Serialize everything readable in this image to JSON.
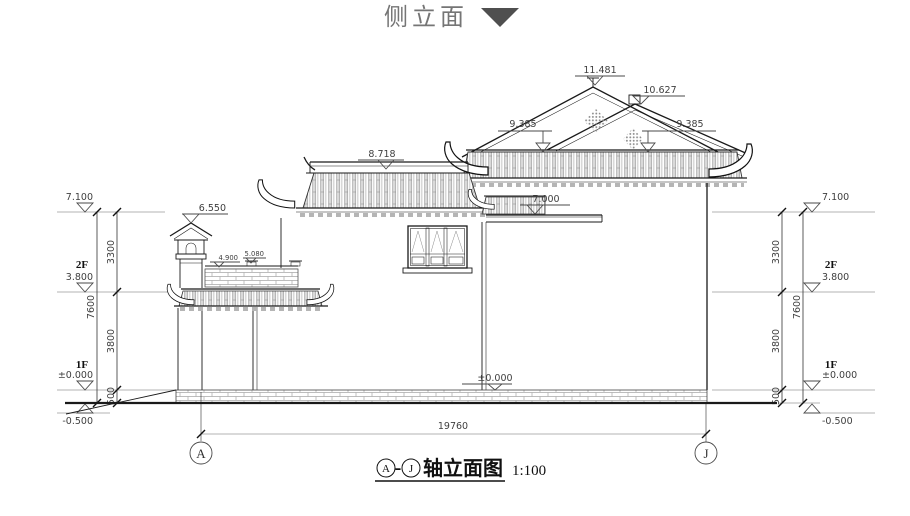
{
  "title": {
    "text": "侧立面"
  },
  "caption": {
    "axis_a": "A",
    "dash": "-",
    "axis_j": "J",
    "label": "轴立面图",
    "scale": "1:100"
  },
  "axes": {
    "a": "A",
    "j": "J"
  },
  "dims": {
    "total_width": "19760"
  },
  "marks": {
    "ridge_main": "11.481",
    "ridge_rear": "10.627",
    "eave_left": "9.385",
    "eave_right": "9.385",
    "left_roof": "8.718",
    "mid_roof": "7.000",
    "tower_top": "6.550",
    "post_cap": "5.080",
    "railing_top": "4.900",
    "ground_center": "±0.000"
  },
  "left_stack": {
    "parapet": "7.100",
    "floor2_label": "2F",
    "floor2": "3.800",
    "floor1_label": "1F",
    "floor1": "±0.000",
    "site": "-0.500",
    "seg_top": "3300",
    "seg_mid": "3800",
    "seg_low": "500",
    "total": "7600"
  },
  "right_stack": {
    "parapet": "7.100",
    "floor2_label": "2F",
    "floor2": "3.800",
    "floor1_label": "1F",
    "floor1": "±0.000",
    "site": "-0.500",
    "seg_top": "3300",
    "seg_mid": "3800",
    "seg_low": "500",
    "total": "7600"
  },
  "colors": {
    "line": "#1a1a1a",
    "dim": "#3f3f3f",
    "ext": "#9a9a9a",
    "title": "#757575",
    "triangle": "#4f4f4f"
  }
}
